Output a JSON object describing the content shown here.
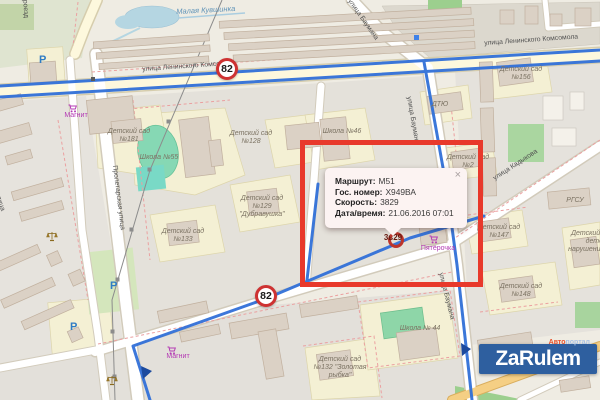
{
  "map": {
    "streets": {
      "leninskogo_komsomola": "улица Ленинского Комсомола",
      "proletarskaya": "Пролетарская улица",
      "baumana": "улица Баумана",
      "kadykova": "улица Кадыкова",
      "proezd": "проезд"
    },
    "water": {
      "stream": "Малая Кувшинка"
    },
    "places": {
      "school55": "Школа №55",
      "school46": "Школа №46",
      "school44": "Школа № 44",
      "ds181": "Детский сад №181",
      "ds128": "Детский сад №128",
      "ds129": "Детский сад №129 \"Дубравушка\"",
      "ds133": "Детский сад №133",
      "ds156": "Детский сад №156",
      "ds2": "Детский сад №2",
      "ds147": "Детский сад №147",
      "ds148": "Детский сад №148",
      "ds132": "Детский сад №132 \"Золотая рыбка\"",
      "ds_speech": "Детский сад для детей с нарушениями речи",
      "dtyu": "ДТЮ",
      "rgsu": "РГСУ"
    },
    "shops": {
      "magnit": "Магнит",
      "pyaterochka": "Пятёрочка"
    },
    "speed_sign": "82",
    "parking": "P"
  },
  "marker": {
    "label": "3ь29",
    "direction_arrow": "▲"
  },
  "popup": {
    "rows": [
      {
        "label": "Маршрут:",
        "value": "М51"
      },
      {
        "label": "Гос. номер:",
        "value": "Х949ВА"
      },
      {
        "label": "Скорость:",
        "value": "3829"
      },
      {
        "label": "Дата/время:",
        "value": "21.06.2016 07:01"
      }
    ],
    "close": "×"
  },
  "logo": {
    "main": "ZaRulem",
    "sub_accent": "Авто",
    "sub_rest": "портал"
  }
}
